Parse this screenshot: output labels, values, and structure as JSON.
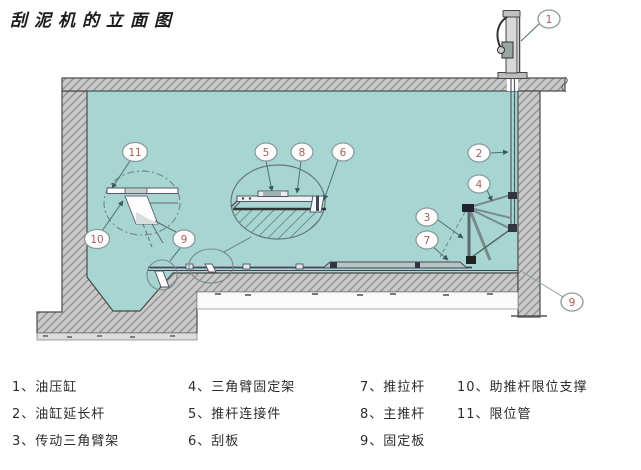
{
  "title": "刮泥机的立面图",
  "legend": [
    {
      "text": "1、油压缸"
    },
    {
      "text": "2、油缸延长杆"
    },
    {
      "text": "3、传动三角臂架"
    },
    {
      "text": "4、三角臂固定架"
    },
    {
      "text": "5、推杆连接件"
    },
    {
      "text": "6、刮板"
    },
    {
      "text": "7、推拉杆"
    },
    {
      "text": "8、主推杆"
    },
    {
      "text": "9、固定板"
    },
    {
      "text": "10、助推杆限位支撑"
    },
    {
      "text": "11、限位管"
    }
  ],
  "callouts": [
    {
      "num": "1"
    },
    {
      "num": "2"
    },
    {
      "num": "4"
    },
    {
      "num": "3"
    },
    {
      "num": "7"
    },
    {
      "num": "5"
    },
    {
      "num": "8"
    },
    {
      "num": "6"
    },
    {
      "num": "11"
    },
    {
      "num": "10"
    },
    {
      "num": "9"
    },
    {
      "num": "9"
    }
  ],
  "colors": {
    "water": "#a7d6d2",
    "concrete": "#c9c9c9",
    "hatch_line": "#8d8d8d",
    "outline": "#4a4a4a",
    "callout_number": "#a85f5f",
    "leader": "#4f6f6f"
  }
}
